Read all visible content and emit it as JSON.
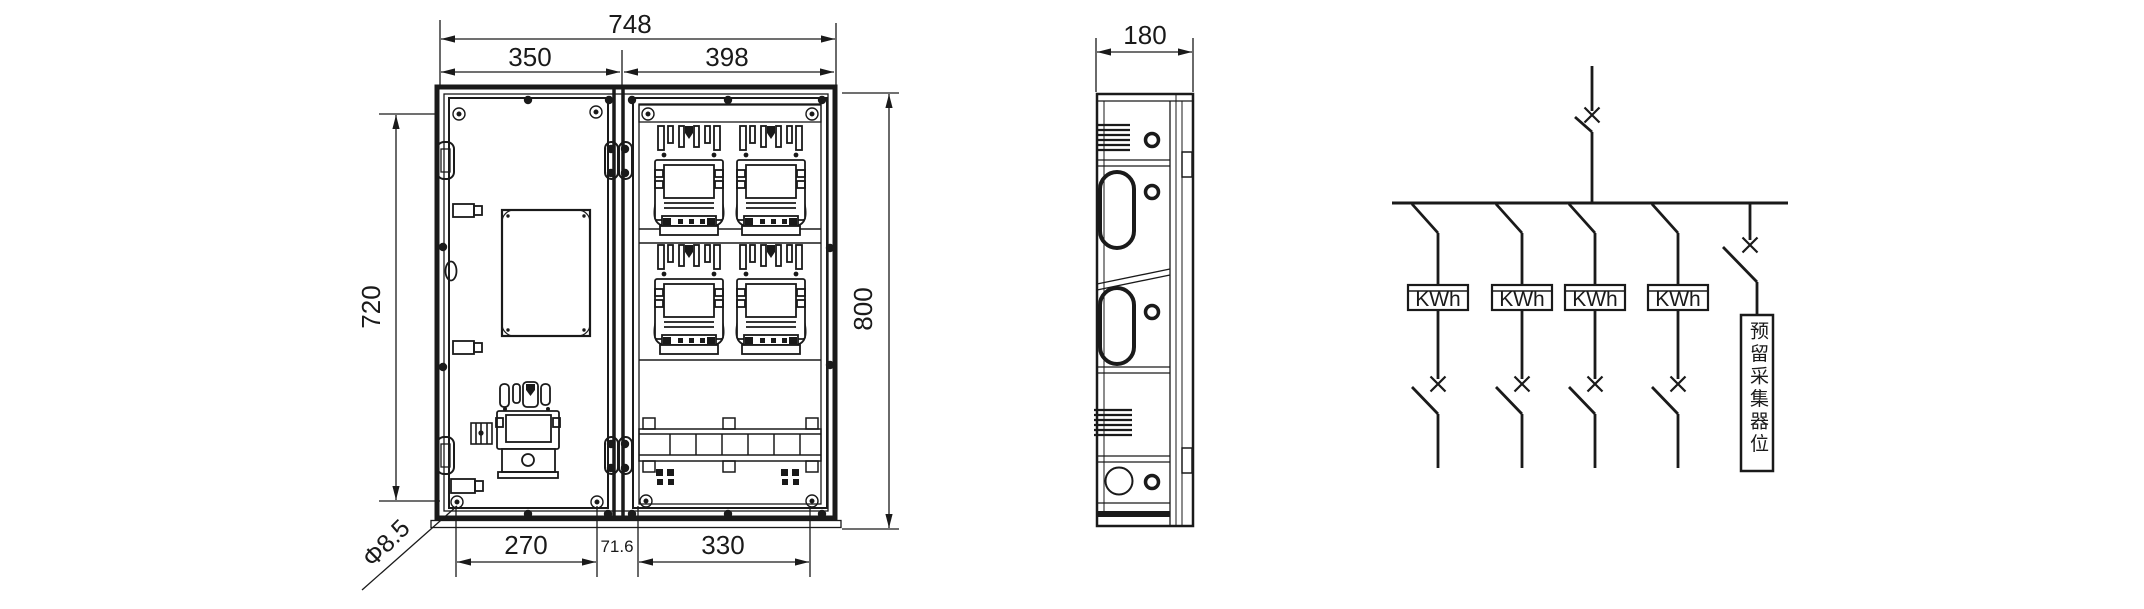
{
  "front_view": {
    "dim_total_width": "748",
    "dim_left_width": "350",
    "dim_right_width": "398",
    "dim_inner_height": "720",
    "dim_total_height": "800",
    "dim_bottom_left_span": "270",
    "dim_bottom_center_span": "71.6",
    "dim_bottom_right_span": "330",
    "dim_hole": "Φ8.5"
  },
  "side_view": {
    "dim_depth": "180"
  },
  "schematic": {
    "meters": [
      {
        "label": "KWh"
      },
      {
        "label": "KWh"
      },
      {
        "label": "KWh"
      },
      {
        "label": "KWh"
      }
    ],
    "reserved_label": "预留采集器位"
  },
  "colors": {
    "line": "#1a1a1a",
    "background": "#ffffff"
  }
}
